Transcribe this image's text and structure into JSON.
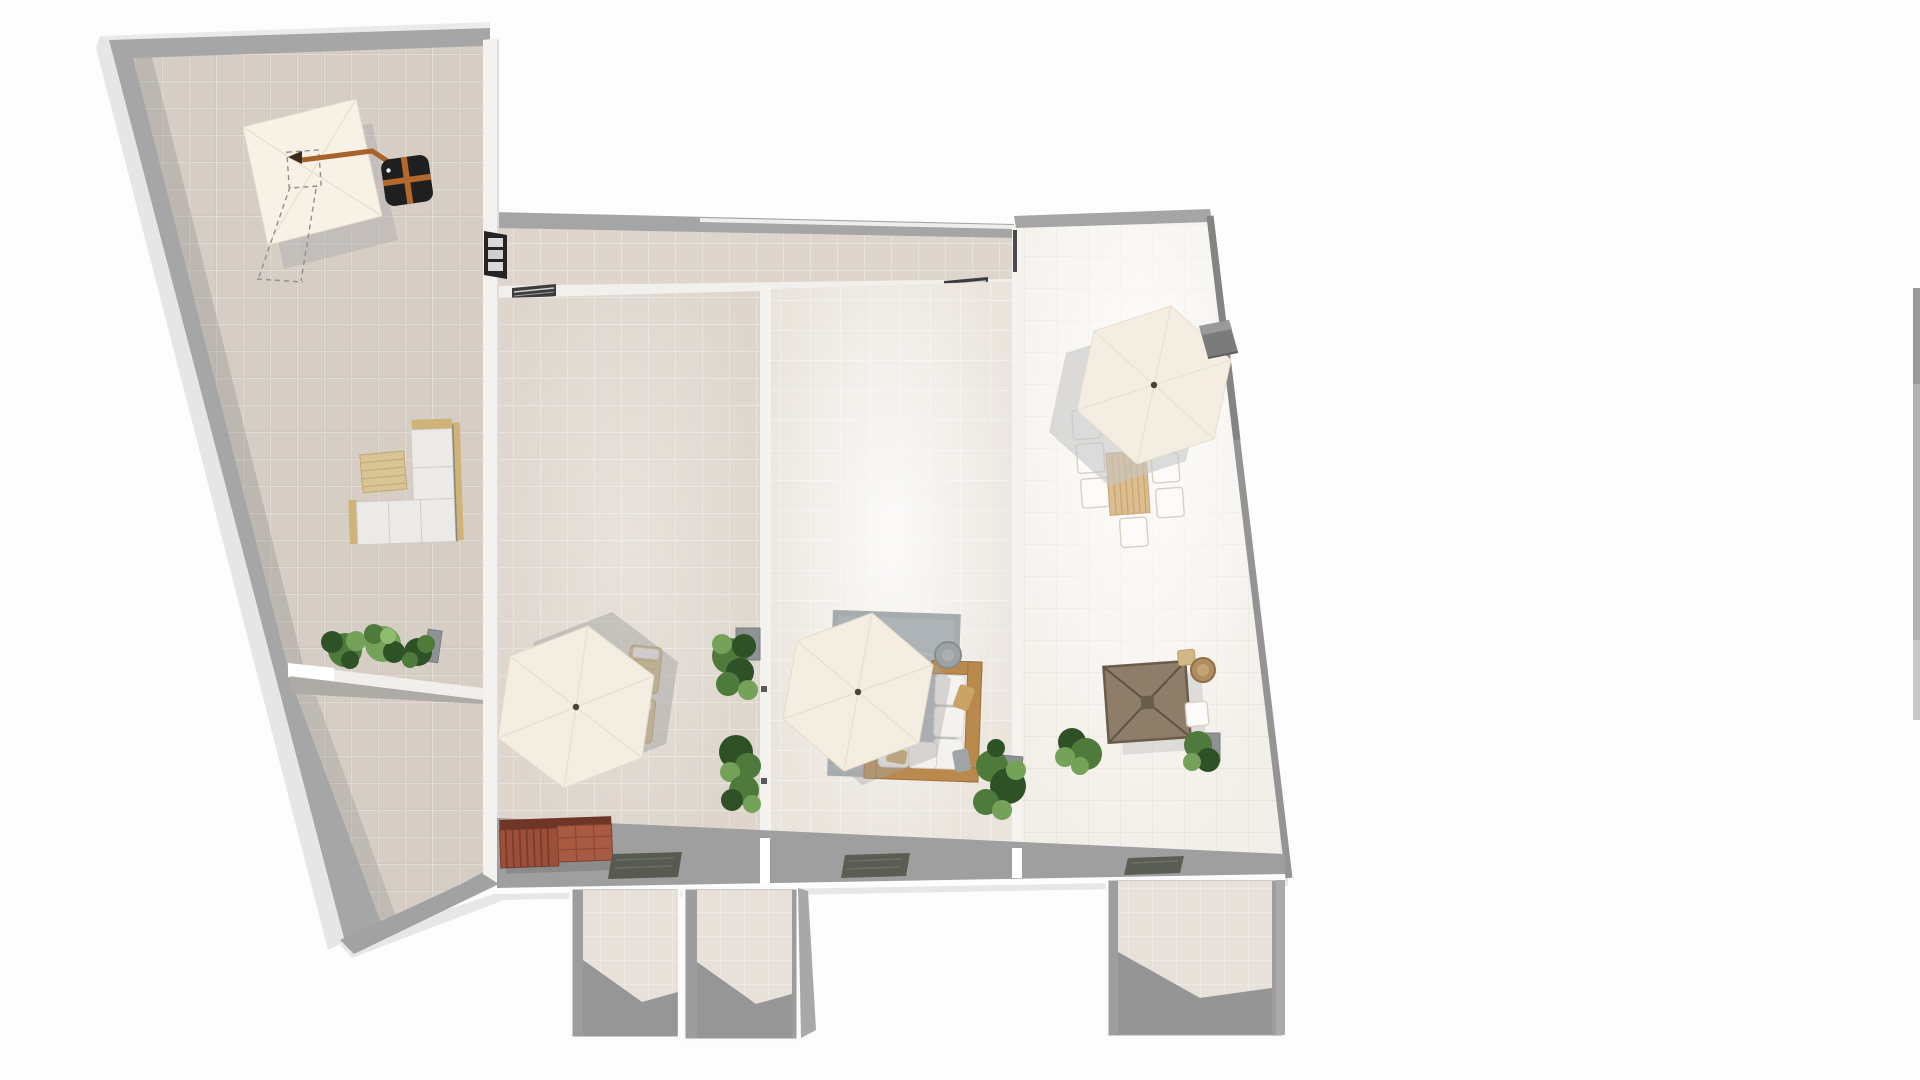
{
  "app": {
    "name": "floor-planner-3d-top-view",
    "view_mode": "top-down 3D render",
    "background_color": "#fdfdfd"
  },
  "colors": {
    "page_background": "#fdfdfd",
    "wall_grey": "#a6a6a6",
    "wall_top_white": "#f2f1ee",
    "wall_shadow": "#8f8f8f",
    "floor_left_room": "#d6cdc4",
    "floor_corridor": "#ded6cd",
    "floor_room3": "#eae4dc",
    "floor_room4": "#f2eee8",
    "floor_bottom_rooms": "#e7e1d9",
    "umbrella_canopy": "#f4eee2",
    "cantilever_canopy": "#f7f2e5",
    "umbrella_base_black": "#1f1f1f",
    "strap_orange": "#b4682e",
    "bench_red": "#a0523c",
    "sofa_white": "#eceae6",
    "wood_frame": "#b9894d",
    "tan_cushion": "#d3b887",
    "rug_grey": "#a6acae",
    "doormat_grey": "#575a50",
    "gazebo_brown": "#8d7d69",
    "table_wood": "#dcbd90",
    "plant_green": "#4e7a3b",
    "chimney_grey": "#7b7b7b"
  },
  "scene": {
    "rooms": {
      "left_terrace": {
        "label": "large slanted terrace room (tiled)"
      },
      "left_lower": {
        "label": "narrow lower-left terrace strip"
      },
      "corridor": {
        "label": "top corridor strip"
      },
      "terrace_2": {
        "label": "second terrace room"
      },
      "terrace_3": {
        "label": "third terrace room"
      },
      "terrace_4": {
        "label": "right bright terrace room"
      },
      "bottom_room_a": {
        "label": "small bottom room A"
      },
      "bottom_room_b": {
        "label": "small bottom room B"
      },
      "bottom_room_c": {
        "label": "small bottom room C"
      }
    },
    "furniture": {
      "cantilever_umbrella": {
        "label": "cantilever patio umbrella with black cross base"
      },
      "selection_outline": {
        "label": "dashed selection footprint"
      },
      "l_sofa_white": {
        "label": "white L-shaped outdoor sofa with tan ottoman"
      },
      "planter_row_left": {
        "label": "planter row with green plants"
      },
      "umbrella_1": {
        "label": "hexagonal parasol, terrace 2"
      },
      "loungers": {
        "label": "pair of tan sun loungers"
      },
      "red_bench": {
        "label": "red-brown slatted storage bench"
      },
      "doormat_1": {
        "label": "dark doormat, terrace 2"
      },
      "plant_column": {
        "label": "plant column along divider wall"
      },
      "umbrella_2": {
        "label": "hexagonal parasol, terrace 3"
      },
      "grey_rug": {
        "label": "grey outdoor rug"
      },
      "wood_sofa": {
        "label": "wooden-frame corner sofa with white cushions"
      },
      "pouf": {
        "label": "round grey pouf"
      },
      "plant_corner_3": {
        "label": "corner plant, terrace 3"
      },
      "doormat_2": {
        "label": "dark doormat, terrace 3"
      },
      "umbrella_3": {
        "label": "hexagonal parasol, terrace 4"
      },
      "dining_set": {
        "label": "wooden dining table with six white chairs"
      },
      "chimney": {
        "label": "dark grey roof vent"
      },
      "gazebo_table": {
        "label": "brown square shade canopy seating set"
      },
      "rattan_table": {
        "label": "round rattan side table"
      },
      "plants_terrace_4": {
        "label": "plants, terrace 4"
      },
      "doormat_3": {
        "label": "dark doormat, terrace 4"
      },
      "window_3pane": {
        "label": "dark 3-pane window in wall"
      },
      "threshold_1": {
        "label": "dark door threshold, corridor wall left"
      },
      "threshold_2": {
        "label": "dark door threshold, corridor wall right"
      },
      "edge_fragment": {
        "label": "grey wall fragment at right viewport edge"
      }
    }
  }
}
